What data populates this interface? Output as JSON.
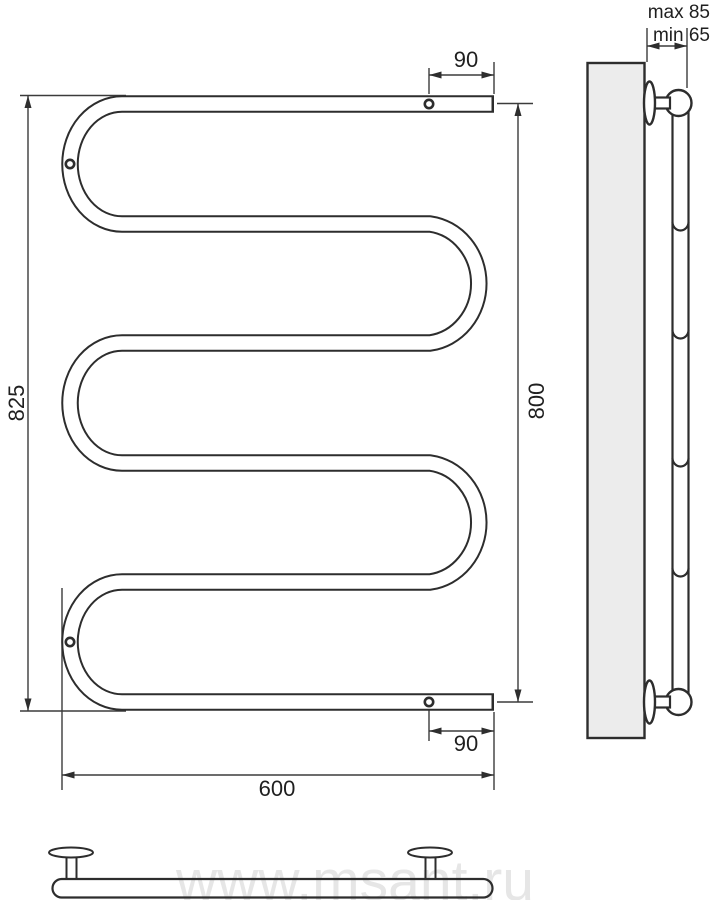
{
  "document": {
    "type": "technical-drawing",
    "subject": "serpentine heated towel rail (M-shape), three projections with dimensions"
  },
  "watermark": "www.msant.ru",
  "colors": {
    "line": "#2d2d2d",
    "dimension_line": "#3b3b3b",
    "wall_fill": "#ececec",
    "watermark": "#e6e6e6",
    "background": "#ffffff"
  },
  "front_view": {
    "dimensions": {
      "overall_height": "825",
      "mounting_axis_height": "800",
      "overall_width": "600",
      "top_hole_offset": "90",
      "bottom_hole_offset": "90"
    }
  },
  "side_view": {
    "dimensions": {
      "wall_distance_max": "max 85",
      "wall_distance_min": "min 65"
    }
  }
}
